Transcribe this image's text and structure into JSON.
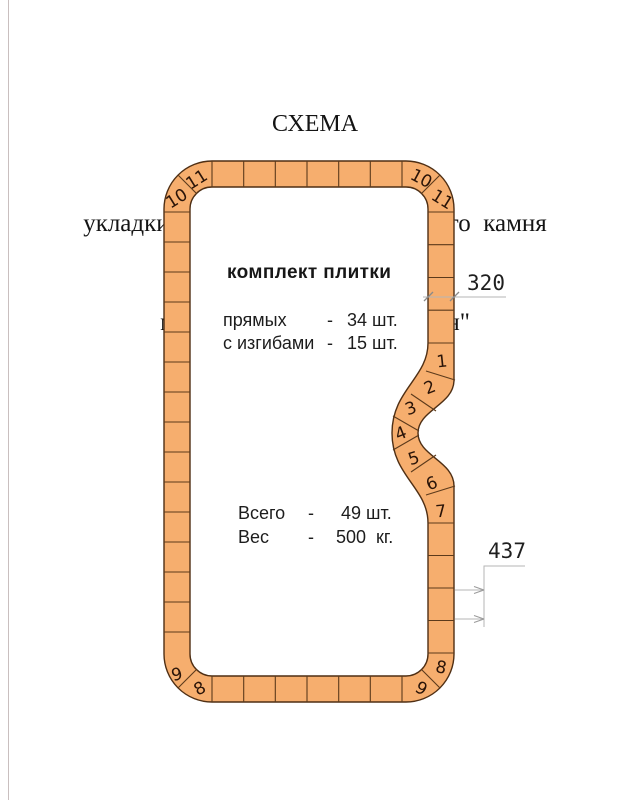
{
  "page_title": {
    "line1": "СХЕМА",
    "line2": "укладки композитного   бордюрного  камня",
    "line3": "модель  бассейна  \"Авиньон\""
  },
  "kit": {
    "heading": "комплект плитки",
    "rows": [
      {
        "label": "прямых",
        "dash": "-",
        "value": "34 шт."
      },
      {
        "label": "с изгибами",
        "dash": "-",
        "value": "15 шт."
      }
    ],
    "totals": [
      {
        "label": "Всего",
        "dash": "-",
        "value": " 49 шт."
      },
      {
        "label": "Вес",
        "dash": "-",
        "value": "500  кг."
      }
    ]
  },
  "dimensions": {
    "tile_width": "320",
    "tile_length": "437"
  },
  "tile_numbers": {
    "curve": [
      "1",
      "2",
      "3",
      "4",
      "5",
      "6",
      "7"
    ],
    "top_left": [
      "10",
      "11"
    ],
    "top_right": [
      "10",
      "11"
    ],
    "bottom_left": [
      "9",
      "8"
    ],
    "bottom_right": [
      "8",
      "9"
    ]
  },
  "colors": {
    "tile_fill": "#F6AE6E",
    "tile_stroke": "#4F2F14",
    "dimension_line": "#B6B6B6",
    "text": "#1D1D1D"
  }
}
